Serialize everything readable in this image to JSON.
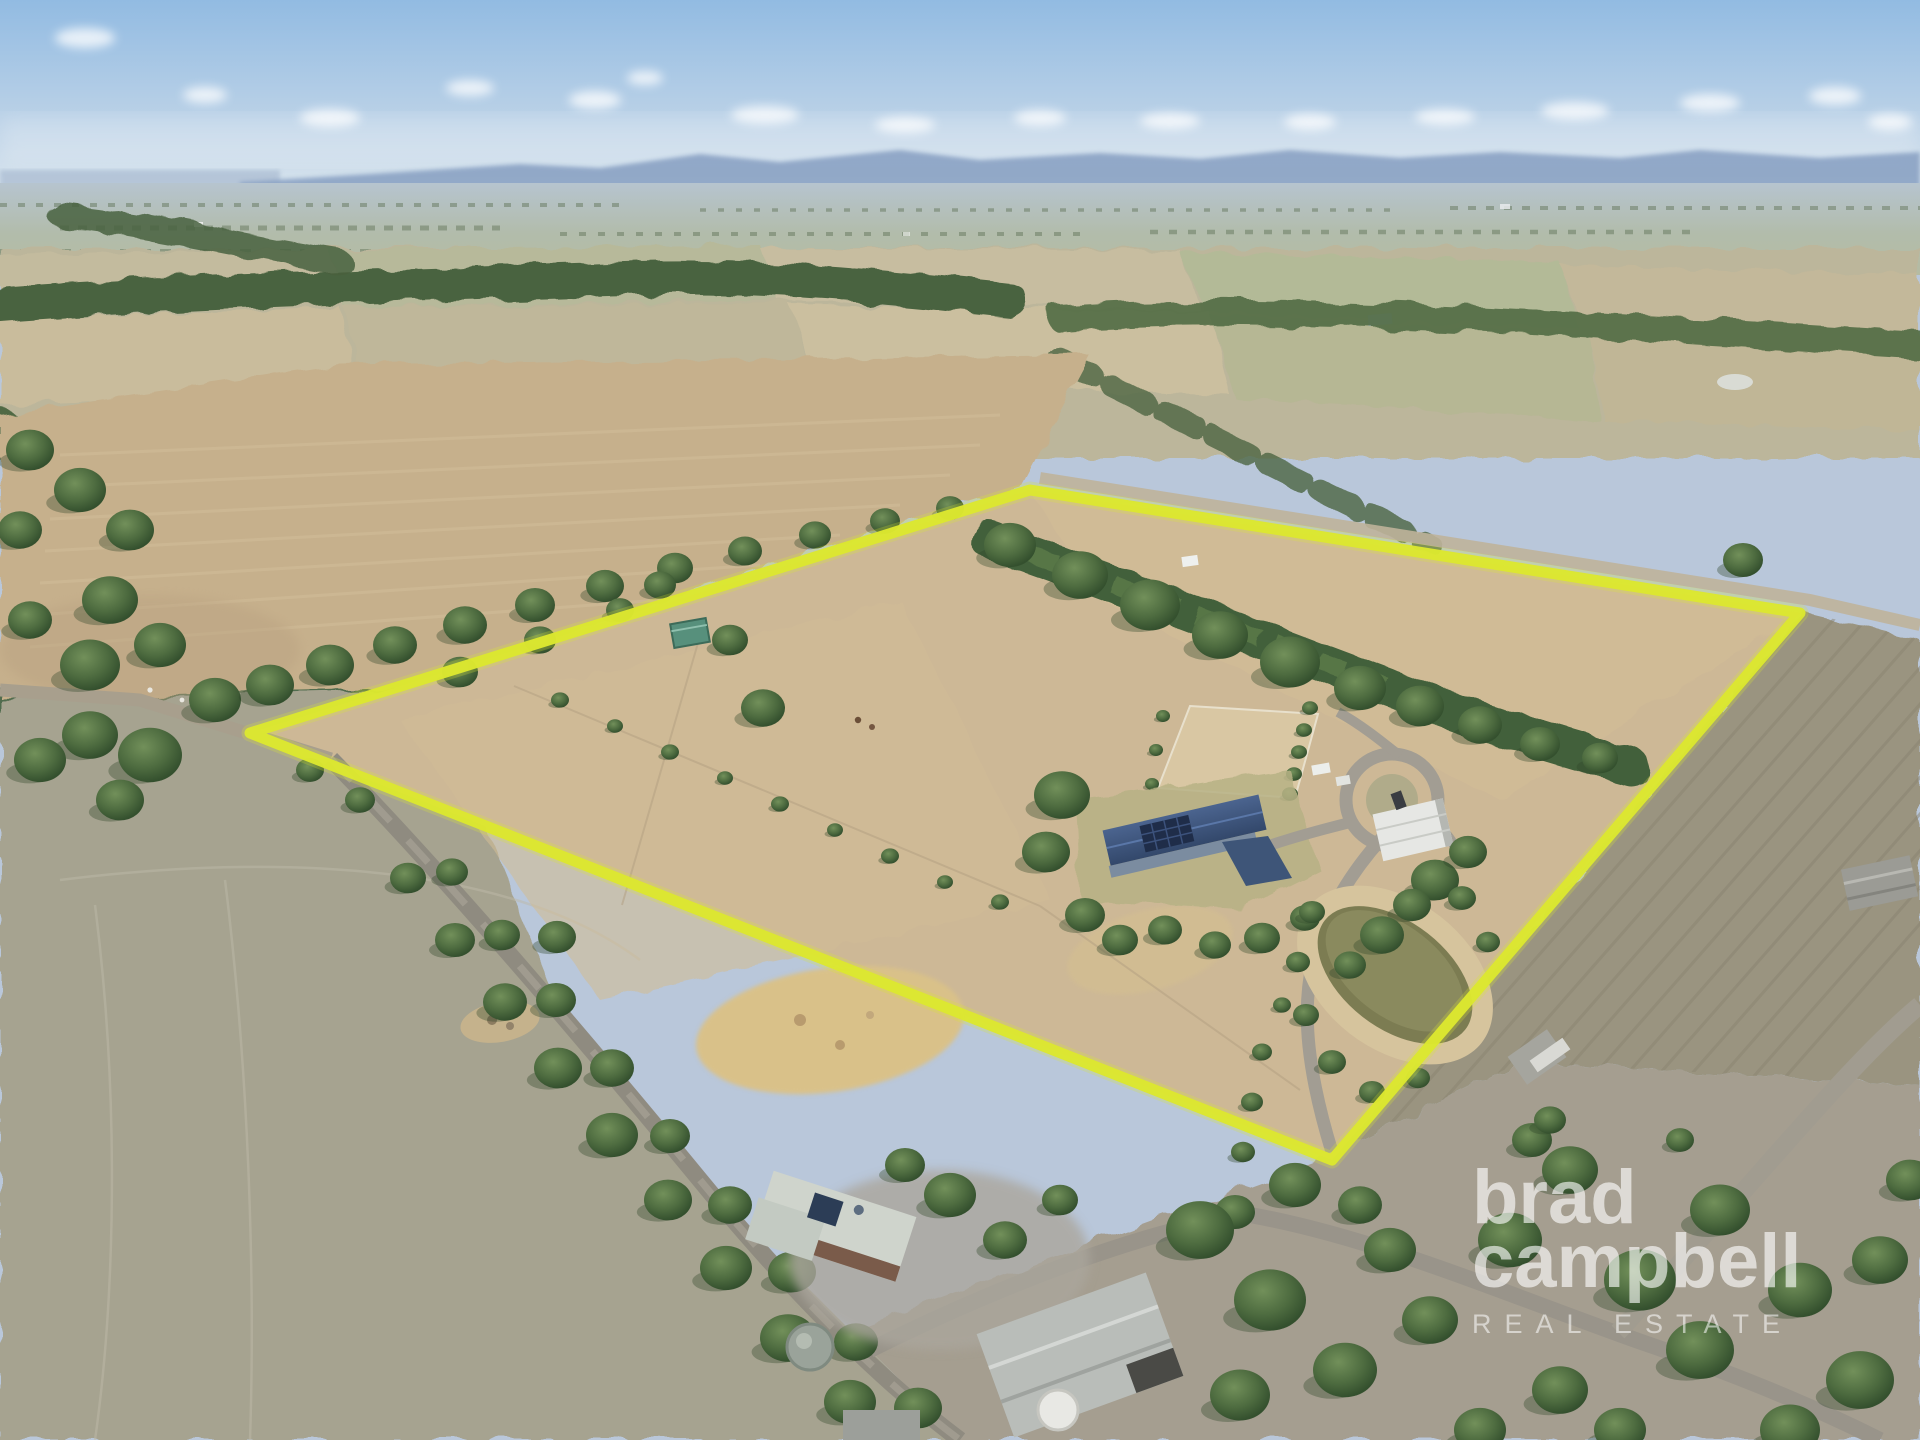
{
  "watermark": {
    "line1": "brad",
    "line2": "campbell",
    "line3": "REAL ESTATE"
  },
  "scene": {
    "description": "Aerial drone photograph of a rural acreage property with highlighted boundary, homestead with solar-panel roof, machinery shed, sand arena, dam, tree windbreaks, surrounding paddocks and country roads",
    "boundary_color": "#dce72f",
    "sky_color": "#92bbe2",
    "mountain_color": "#8ba3c4",
    "dry_grass_color": "#cdb896",
    "plowed_field_color": "#c6b08c",
    "tree_color": "#44603a",
    "dam_water_color": "#8a8a5e",
    "house_roof_color": "#3d5377",
    "road_color": "#8f8b80"
  }
}
